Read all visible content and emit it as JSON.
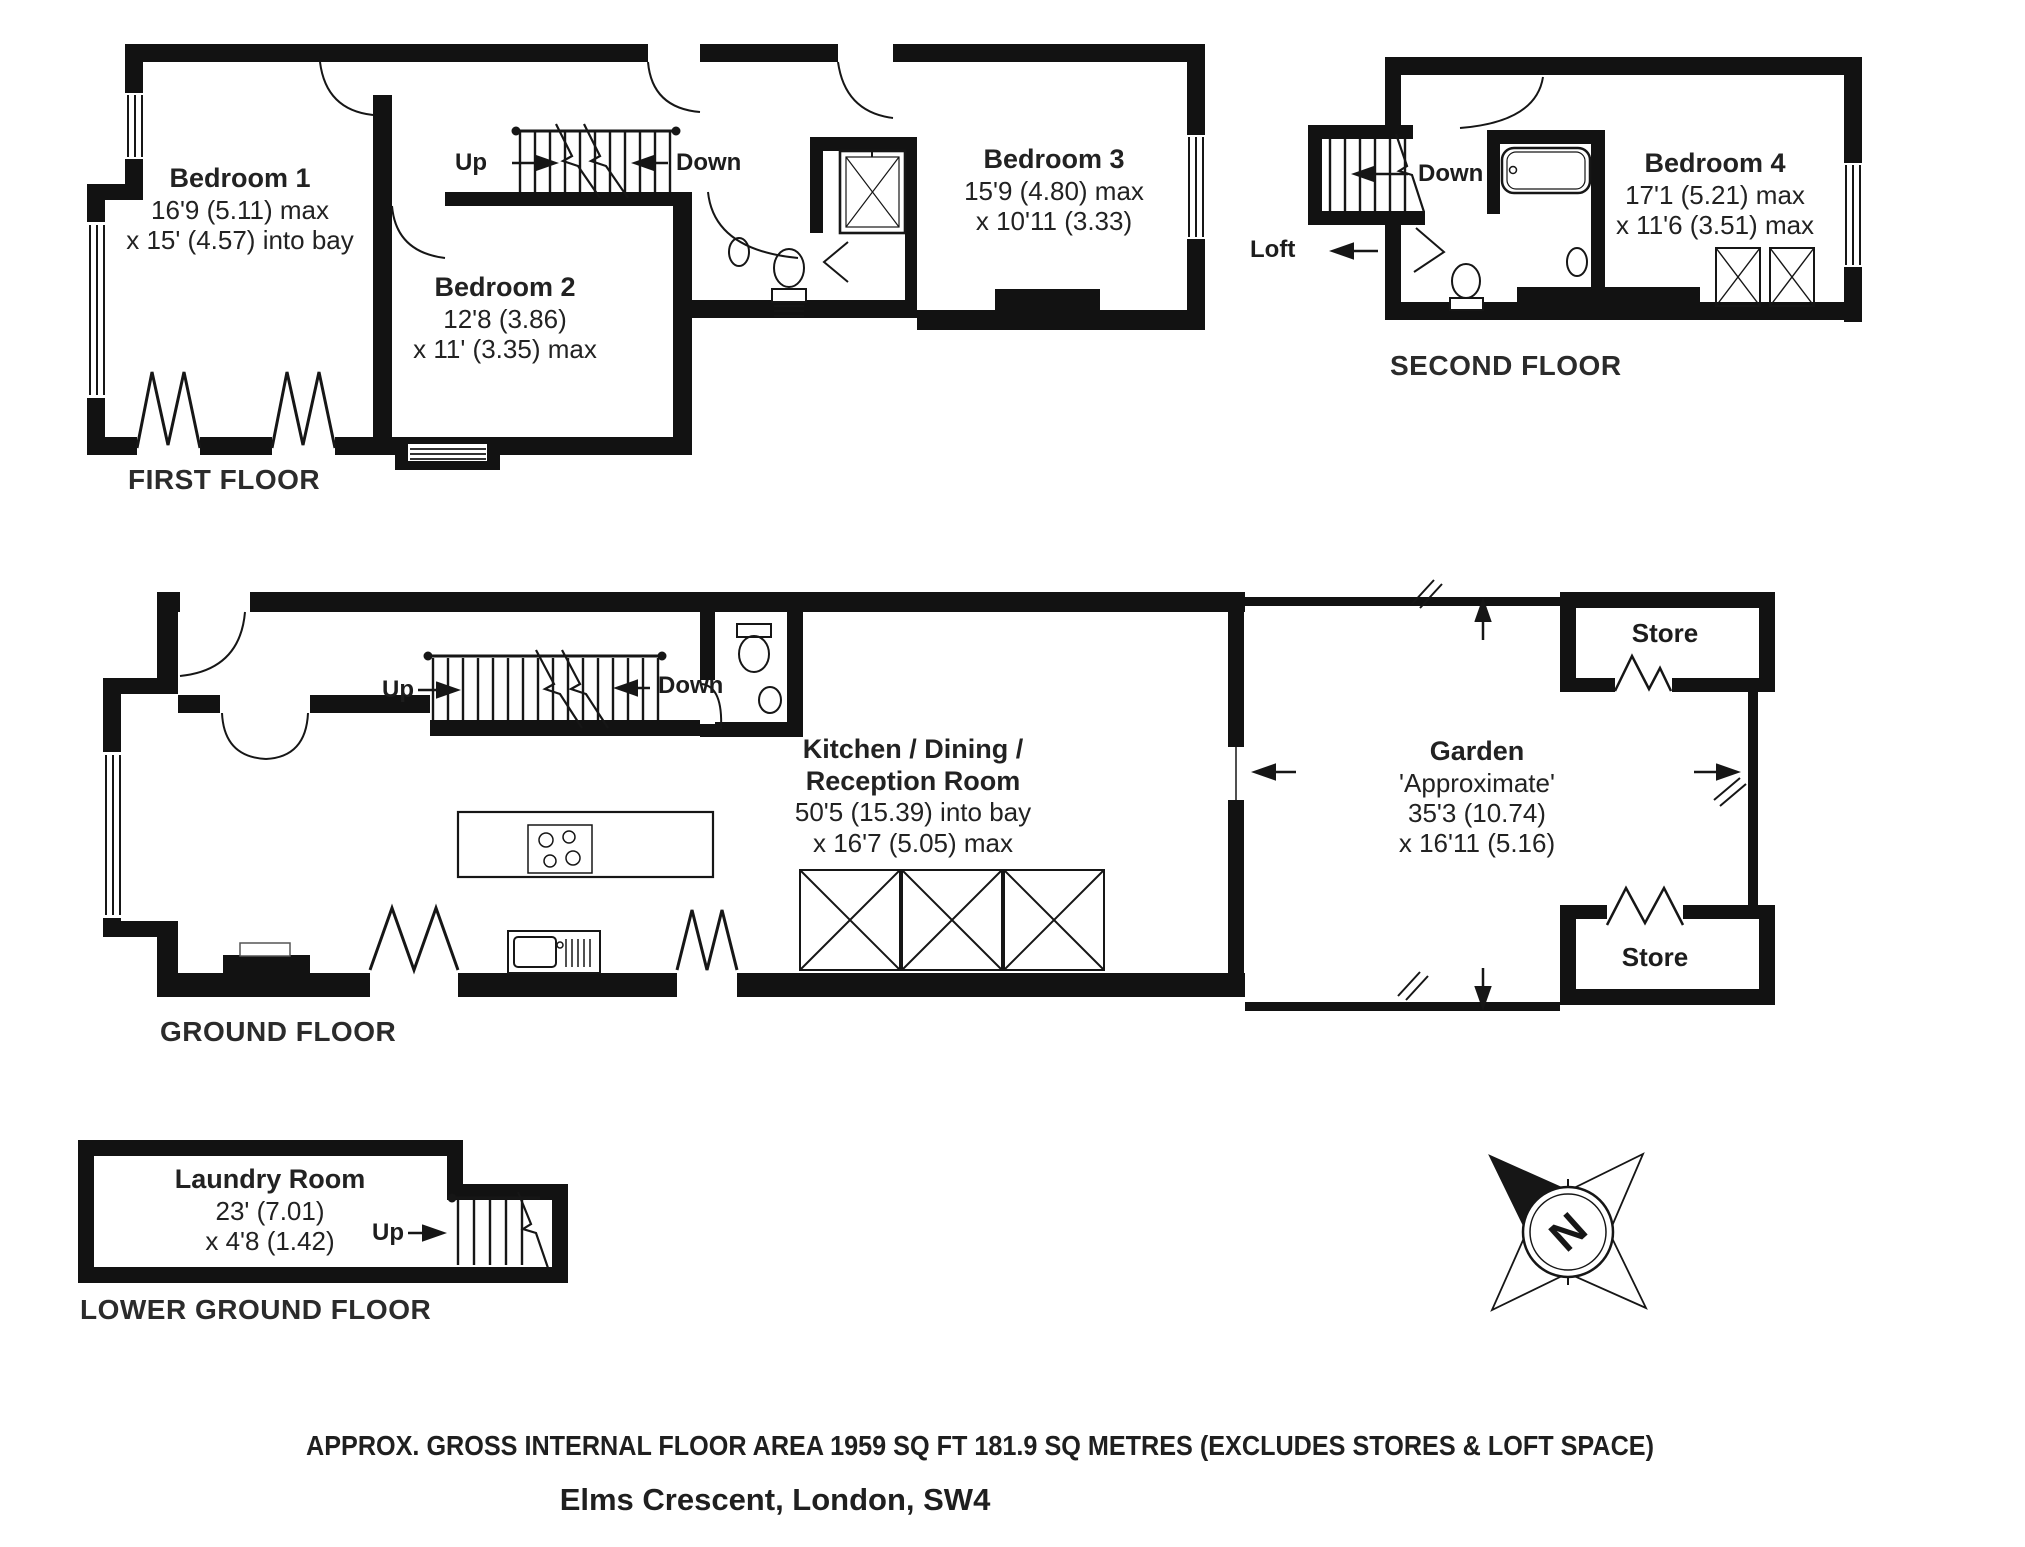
{
  "first_floor": {
    "label": "FIRST FLOOR",
    "bedroom1": {
      "name": "Bedroom 1",
      "dim1": "16'9 (5.11) max",
      "dim2": "x 15' (4.57) into bay"
    },
    "bedroom2": {
      "name": "Bedroom 2",
      "dim1": "12'8 (3.86)",
      "dim2": "x 11' (3.35) max"
    },
    "bedroom3": {
      "name": "Bedroom 3",
      "dim1": "15'9 (4.80) max",
      "dim2": "x 10'11 (3.33)"
    },
    "up": "Up",
    "down": "Down"
  },
  "second_floor": {
    "label": "SECOND FLOOR",
    "bedroom4": {
      "name": "Bedroom 4",
      "dim1": "17'1 (5.21) max",
      "dim2": "x 11'6 (3.51) max"
    },
    "down": "Down",
    "loft": "Loft"
  },
  "ground_floor": {
    "label": "GROUND FLOOR",
    "kitchen": {
      "name1": "Kitchen / Dining /",
      "name2": "Reception Room",
      "dim1": "50'5 (15.39) into bay",
      "dim2": "x 16'7 (5.05) max"
    },
    "garden": {
      "name": "Garden",
      "note": "'Approximate'",
      "dim1": "35'3 (10.74)",
      "dim2": "x 16'11 (5.16)"
    },
    "store_top": "Store",
    "store_bottom": "Store",
    "up": "Up",
    "down": "Down"
  },
  "lower_ground_floor": {
    "label": "LOWER GROUND FLOOR",
    "laundry": {
      "name": "Laundry Room",
      "dim1": "23' (7.01)",
      "dim2": "x 4'8 (1.42)"
    },
    "up": "Up"
  },
  "compass": {
    "n": "N"
  },
  "footer": {
    "area_line": "APPROX. GROSS INTERNAL FLOOR AREA 1959 SQ FT 181.9 SQ METRES (EXCLUDES STORES & LOFT SPACE)",
    "address_line": "Elms Crescent, London, SW4"
  },
  "colors": {
    "walls": "#121212",
    "text": "#222222"
  }
}
